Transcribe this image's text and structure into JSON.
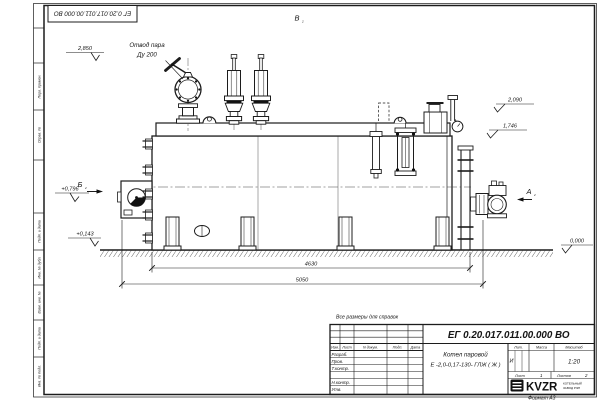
{
  "drawing": {
    "stamp_number": "ЕГ 0.20.017.011.00.000  ВО",
    "number": "ЕГ 0.20.017.011.00.000  ВО",
    "product_line1": "Котел паровой",
    "product_line2": "Е -2,0-0,17-130- ГЛЖ ( Ж )",
    "reference_note": "Все размеры для справок",
    "format_label": "Формат  А3"
  },
  "title_block": {
    "change_header": {
      "izm": "Изм.",
      "list": "Лист",
      "doc": "N докум.",
      "sign": "Подп.",
      "date": "Дата"
    },
    "signature_rows": [
      "Разраб.",
      "Пров.",
      "Т.контр.",
      "Н.контр.",
      "Утв."
    ],
    "lit_label": "Лит.",
    "lit_value": "И",
    "mass_label": "Масса",
    "scale_label": "Масштаб",
    "scale_value": "1:20",
    "sheet_label": "Лист",
    "sheet_number": "1",
    "sheets_label": "Листов",
    "sheets_total": "2",
    "logo_text": "KVZR",
    "logo_sub_line1": "КОТЕЛЬНЫЙ",
    "logo_sub_line2": "ЗАВОД РЭП"
  },
  "margin_labels": [
    "Перв. примен.",
    "Справ. №",
    "Подп. и дата",
    "Инв. № дубл.",
    "Взам. инв. №",
    "Подп. и дата",
    "Инв. № подл."
  ],
  "annotations": {
    "steam_outlet_line1": "Отвод пара",
    "steam_outlet_line2": "Ду 200",
    "elev_top_left": "2,850",
    "elev_right_upper": "2,090",
    "elev_right_lower": "1,746",
    "elev_left_mid": "+0,796",
    "elev_left_low": "+0,143",
    "elev_ground": "0,000",
    "view_a": "А",
    "view_b": "Б",
    "view_v": "В",
    "view_sub": "2",
    "dim_inner": "4630",
    "dim_outer": "5050"
  },
  "colors": {
    "line": "#1c1c1c",
    "paper": "#ffffff"
  }
}
